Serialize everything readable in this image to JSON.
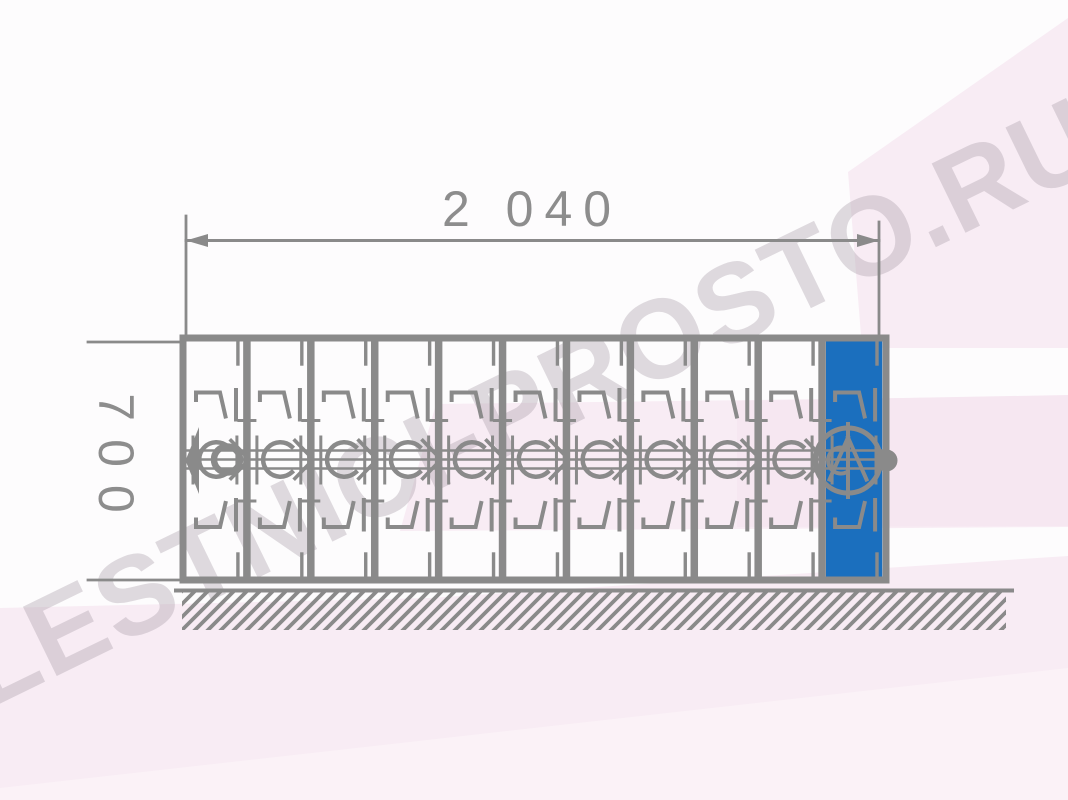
{
  "page": {
    "width": 1068,
    "height": 800,
    "canvas_color": "#fdfcfd"
  },
  "watermark": {
    "text": "LESTNICI-PROSTO.RU",
    "color": "rgba(172,160,172,0.38)",
    "angle_deg": -26
  },
  "diagram": {
    "kind": "technical-drawing-folding-ladder-elevation",
    "line_color": "#8a8a8a",
    "dim_color": "#8d8d8d",
    "highlight_color": "#1b6fbe",
    "pink_accent": "#f8ecf4",
    "pink_accent_deep": "#f6e7f1",
    "pink_accent_light": "#fbf2f7",
    "dims": {
      "width_label": "2 040",
      "height_label": "700"
    },
    "sections": {
      "count": 11,
      "highlighted_index": 11
    },
    "frame": {
      "left": 183,
      "right": 886,
      "top": 338,
      "bottom": 580
    },
    "center_band_y": [
      450.5,
      459.5,
      468.5
    ],
    "ground": {
      "line_y": 590.5,
      "x1": 176,
      "x2": 1012,
      "hatch_x1": 182,
      "hatch_x2": 1006,
      "hatch_bottom": 630
    },
    "dim_line": {
      "y": 240.5,
      "x1": 186,
      "x2": 879
    },
    "end_markers": {
      "left": "arrow",
      "right": "ball"
    }
  }
}
